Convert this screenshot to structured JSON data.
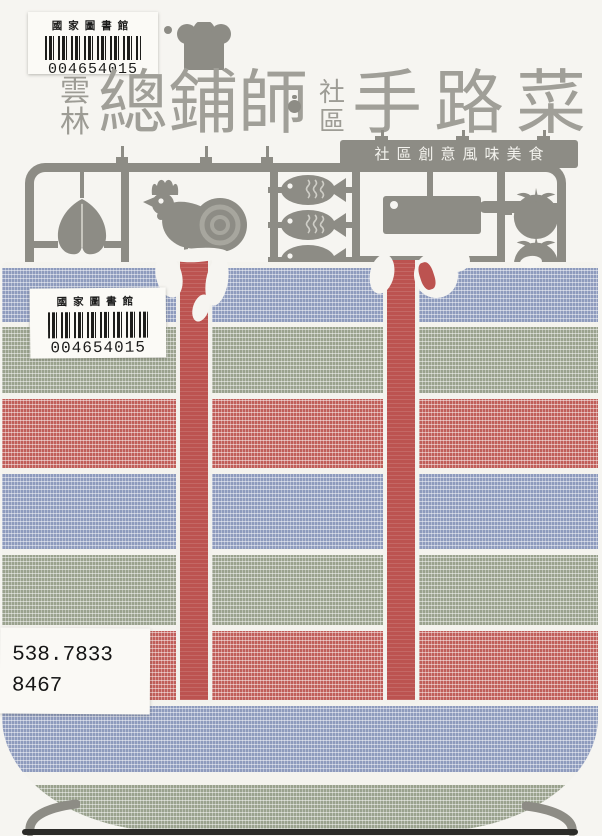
{
  "cover": {
    "region_chars": [
      "雲",
      "林"
    ],
    "title_left": "總鋪師",
    "separator_dot": "·",
    "community_chars": [
      "社",
      "區"
    ],
    "title_right": "手路菜",
    "banner": "社區創意風味美食"
  },
  "library_labels": {
    "top": {
      "name": "國家圖書館",
      "number": "004654015"
    },
    "bag": {
      "name": "國家圖書館",
      "number": "004654015"
    },
    "call_number": {
      "line1": "538.7833",
      "line2": "8467"
    }
  },
  "icons": {
    "chef_hat": "chef-hat-icon",
    "pork_cut": "pork-cut-icon",
    "rooster": "rooster-icon",
    "fish": "fish-icon",
    "cleaver": "cleaver-icon",
    "tomato": "tomato-icon",
    "wok_handle_left": "wok-handle-icon",
    "wok_handle_right": "wok-handle-icon"
  },
  "colors": {
    "sprue_gray": "#8d8c85",
    "title_gray": "#a09f98",
    "stripe_red": "#c05e59",
    "stripe_blue": "#8e9bbd",
    "stripe_green": "#9aa28e",
    "handle_red": "#bc5350",
    "paper": "#f6f5f1",
    "bag_paper": "#f4f3ee"
  }
}
